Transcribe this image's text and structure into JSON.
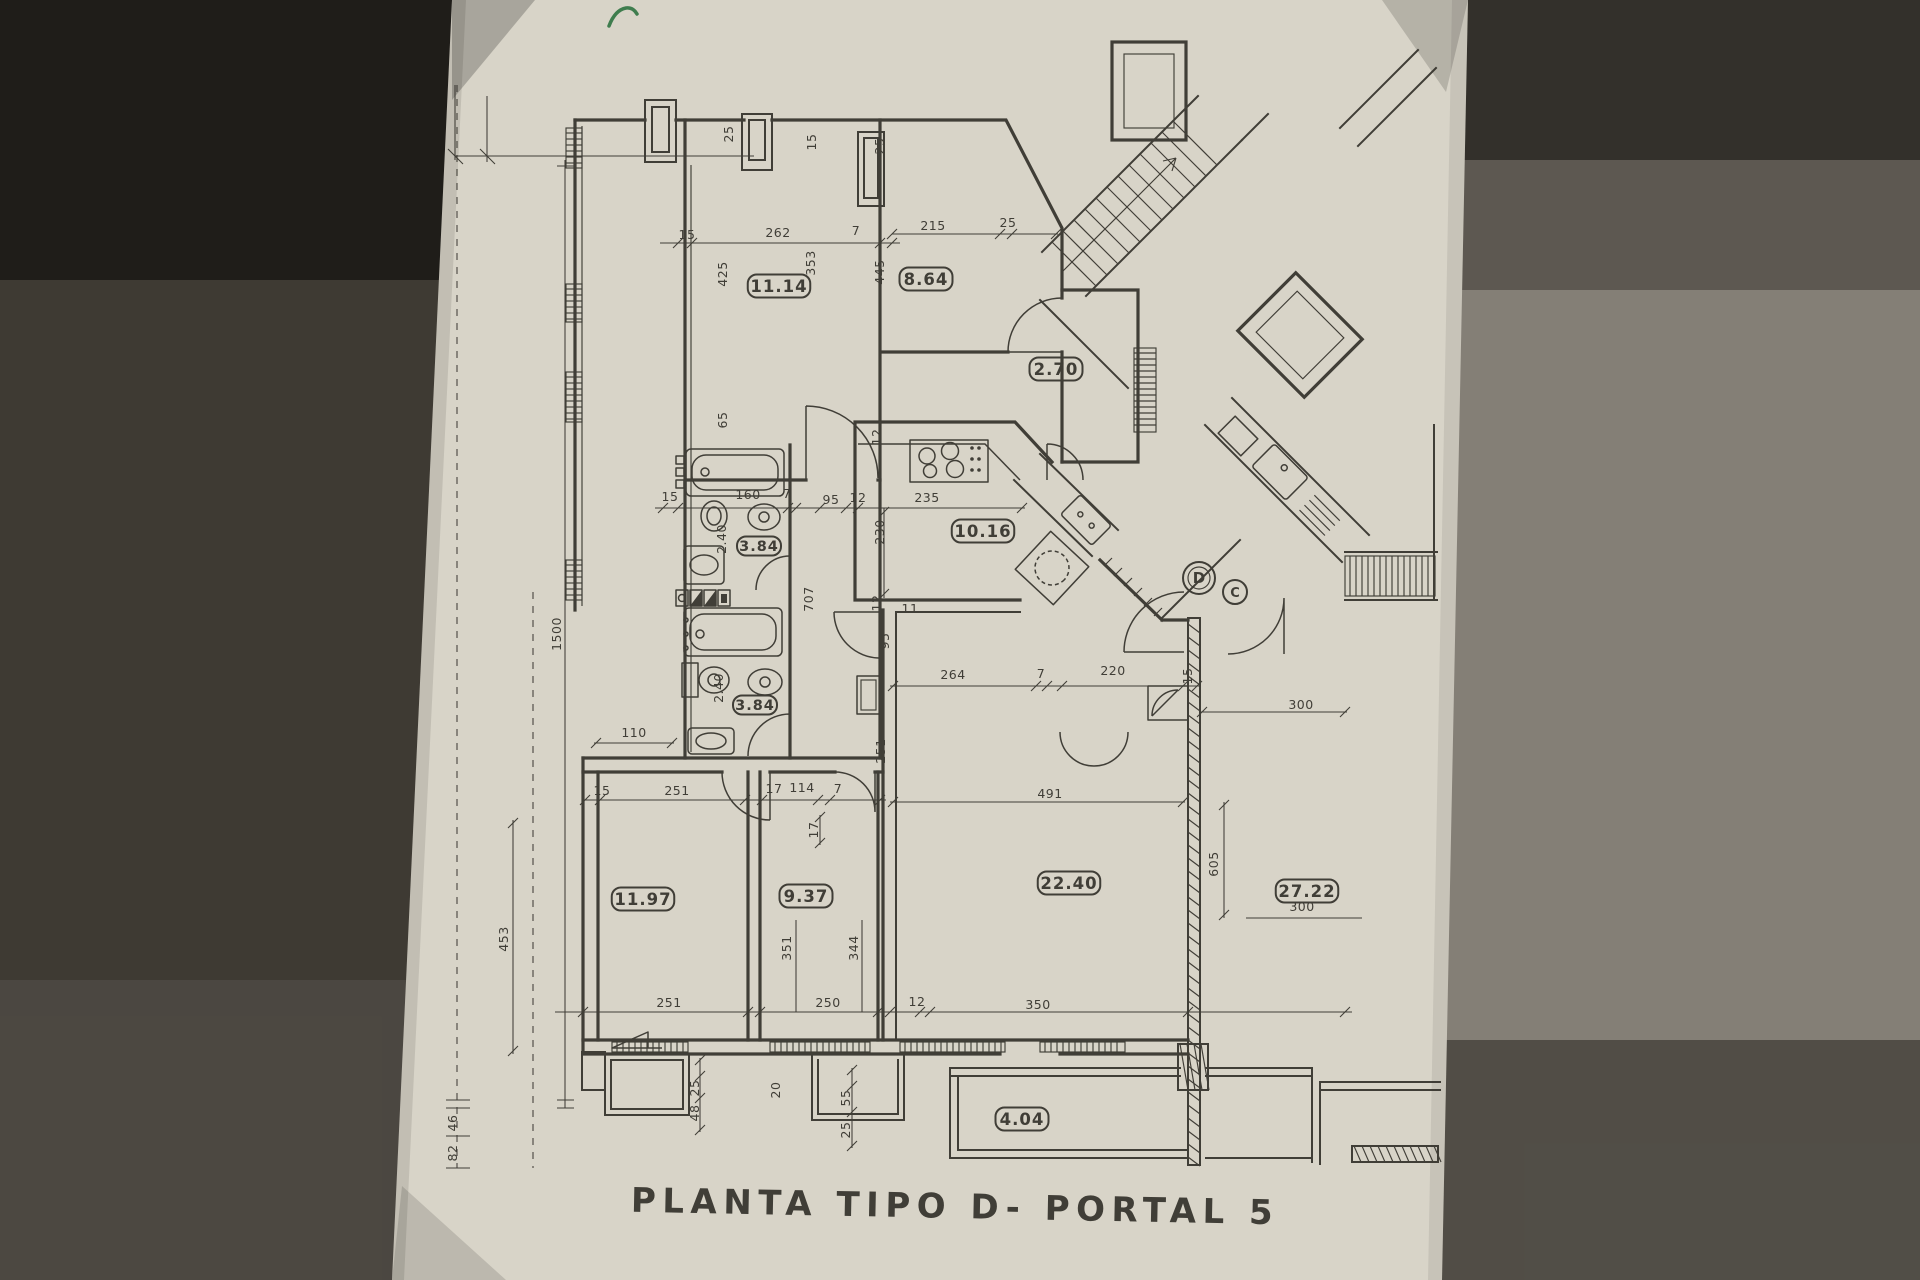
{
  "photo": {
    "paper_color": "#d8d4c8",
    "ink_color": "#33302a",
    "surround_left_color": "#3e3a33",
    "surround_right_color": "#847f76",
    "green_mark_color": "#3f7d4e"
  },
  "title": {
    "text": "PLANTA TIPO D- PORTAL 5"
  },
  "door_markers": [
    {
      "label": "D",
      "x": 1199,
      "y": 578,
      "r": 16,
      "double": true
    },
    {
      "label": "C",
      "x": 1235,
      "y": 592,
      "r": 12,
      "double": false
    }
  ],
  "room_area_labels": [
    {
      "value": "11.14",
      "x": 779,
      "y": 286,
      "small": false
    },
    {
      "value": "8.64",
      "x": 926,
      "y": 279,
      "small": false
    },
    {
      "value": "2.70",
      "x": 1056,
      "y": 369,
      "small": false
    },
    {
      "value": "10.16",
      "x": 983,
      "y": 531,
      "small": false
    },
    {
      "value": "3.84",
      "x": 759,
      "y": 546,
      "small": true
    },
    {
      "value": "3.84",
      "x": 755,
      "y": 705,
      "small": true
    },
    {
      "value": "11.97",
      "x": 643,
      "y": 899,
      "small": false
    },
    {
      "value": "9.37",
      "x": 806,
      "y": 896,
      "small": false
    },
    {
      "value": "22.40",
      "x": 1069,
      "y": 883,
      "small": false
    },
    {
      "value": "27.22",
      "x": 1307,
      "y": 891,
      "small": false
    },
    {
      "value": "4.04",
      "x": 1022,
      "y": 1119,
      "small": false
    }
  ],
  "dimension_labels": [
    {
      "t": "25",
      "x": 733,
      "y": 134,
      "r": -90
    },
    {
      "t": "15",
      "x": 816,
      "y": 142,
      "r": -90
    },
    {
      "t": "25",
      "x": 884,
      "y": 146,
      "r": -90
    },
    {
      "t": "15",
      "x": 687,
      "y": 239,
      "r": 0
    },
    {
      "t": "262",
      "x": 778,
      "y": 237,
      "r": 0
    },
    {
      "t": "7",
      "x": 856,
      "y": 235,
      "r": 0
    },
    {
      "t": "215",
      "x": 933,
      "y": 230,
      "r": 0
    },
    {
      "t": "25",
      "x": 1008,
      "y": 227,
      "r": 0
    },
    {
      "t": "425",
      "x": 727,
      "y": 274,
      "r": -90
    },
    {
      "t": "353",
      "x": 815,
      "y": 263,
      "r": -90
    },
    {
      "t": "445",
      "x": 884,
      "y": 272,
      "r": -90
    },
    {
      "t": "65",
      "x": 727,
      "y": 420,
      "r": -90
    },
    {
      "t": "12",
      "x": 881,
      "y": 437,
      "r": -90
    },
    {
      "t": "15",
      "x": 670,
      "y": 501,
      "r": 0
    },
    {
      "t": "160",
      "x": 748,
      "y": 499,
      "r": 0
    },
    {
      "t": "7",
      "x": 787,
      "y": 498,
      "r": 0
    },
    {
      "t": "95",
      "x": 831,
      "y": 504,
      "r": 0
    },
    {
      "t": "12",
      "x": 858,
      "y": 502,
      "r": 0
    },
    {
      "t": "235",
      "x": 927,
      "y": 502,
      "r": 0
    },
    {
      "t": "230",
      "x": 884,
      "y": 532,
      "r": -90
    },
    {
      "t": "2.40",
      "x": 726,
      "y": 539,
      "r": -90
    },
    {
      "t": "707",
      "x": 813,
      "y": 599,
      "r": -90
    },
    {
      "t": "12",
      "x": 881,
      "y": 603,
      "r": -90
    },
    {
      "t": "11",
      "x": 910,
      "y": 613,
      "r": 0
    },
    {
      "t": "95",
      "x": 889,
      "y": 641,
      "r": -90
    },
    {
      "t": "2.40",
      "x": 723,
      "y": 688,
      "r": -90
    },
    {
      "t": "264",
      "x": 953,
      "y": 679,
      "r": 0
    },
    {
      "t": "7",
      "x": 1041,
      "y": 678,
      "r": 0
    },
    {
      "t": "220",
      "x": 1113,
      "y": 675,
      "r": 0
    },
    {
      "t": "15",
      "x": 1192,
      "y": 676,
      "r": -90
    },
    {
      "t": "300",
      "x": 1301,
      "y": 709,
      "r": 0
    },
    {
      "t": "110",
      "x": 634,
      "y": 737,
      "r": 0
    },
    {
      "t": "251",
      "x": 885,
      "y": 751,
      "r": -90
    },
    {
      "t": "15",
      "x": 602,
      "y": 795,
      "r": 0
    },
    {
      "t": "251",
      "x": 677,
      "y": 795,
      "r": 0
    },
    {
      "t": "17",
      "x": 774,
      "y": 793,
      "r": 0
    },
    {
      "t": "114",
      "x": 802,
      "y": 792,
      "r": 0
    },
    {
      "t": "7",
      "x": 838,
      "y": 793,
      "r": 0
    },
    {
      "t": "491",
      "x": 1050,
      "y": 798,
      "r": 0
    },
    {
      "t": "17",
      "x": 818,
      "y": 830,
      "r": -90
    },
    {
      "t": "605",
      "x": 1218,
      "y": 864,
      "r": -90
    },
    {
      "t": "300",
      "x": 1302,
      "y": 911,
      "r": 0
    },
    {
      "t": "453",
      "x": 508,
      "y": 939,
      "r": -90
    },
    {
      "t": "351",
      "x": 791,
      "y": 948,
      "r": -90
    },
    {
      "t": "344",
      "x": 858,
      "y": 948,
      "r": -90
    },
    {
      "t": "1500",
      "x": 561,
      "y": 634,
      "r": -90
    },
    {
      "t": "251",
      "x": 669,
      "y": 1007,
      "r": 0
    },
    {
      "t": "250",
      "x": 828,
      "y": 1007,
      "r": 0
    },
    {
      "t": "12",
      "x": 917,
      "y": 1006,
      "r": 0
    },
    {
      "t": "350",
      "x": 1038,
      "y": 1009,
      "r": 0
    },
    {
      "t": "25",
      "x": 699,
      "y": 1088,
      "r": -90
    },
    {
      "t": "48",
      "x": 699,
      "y": 1113,
      "r": -90
    },
    {
      "t": "20",
      "x": 780,
      "y": 1090,
      "r": -90
    },
    {
      "t": "55",
      "x": 850,
      "y": 1098,
      "r": -90
    },
    {
      "t": "25",
      "x": 850,
      "y": 1130,
      "r": -90
    },
    {
      "t": "46",
      "x": 457,
      "y": 1123,
      "r": -90
    },
    {
      "t": "82",
      "x": 457,
      "y": 1153,
      "r": -90
    }
  ]
}
